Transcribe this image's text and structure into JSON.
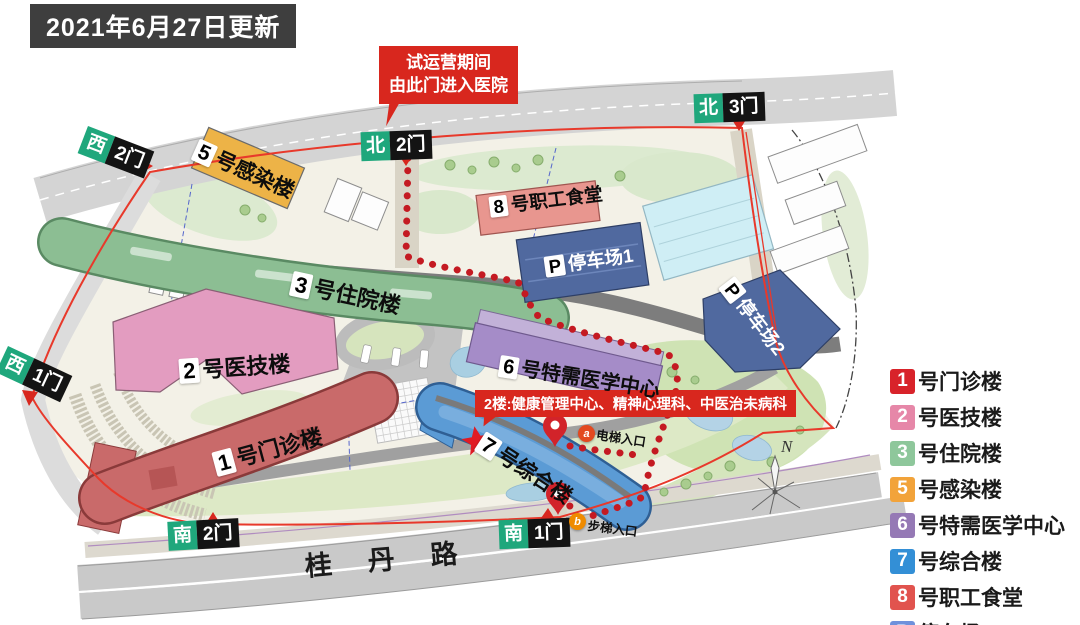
{
  "title_banner": "2021年6月27日更新",
  "callout": {
    "line1": "试运营期间",
    "line2": "由此门进入医院"
  },
  "floor2_note": "2楼:健康管理中心、精神心理科、中医治未病科",
  "road_name": "桂丹路",
  "compass_label": "N",
  "gates": {
    "west2": {
      "direction": "西",
      "gate": "2门"
    },
    "west1": {
      "direction": "西",
      "gate": "1门"
    },
    "north2": {
      "direction": "北",
      "gate": "2门"
    },
    "north3": {
      "direction": "北",
      "gate": "3门"
    },
    "south2": {
      "direction": "南",
      "gate": "2门"
    },
    "south1": {
      "direction": "南",
      "gate": "1门"
    }
  },
  "buildings": {
    "b1": {
      "num": "1",
      "name": "号门诊楼",
      "color": "#c96a6a"
    },
    "b2": {
      "num": "2",
      "name": "号医技楼",
      "color": "#e39cc0"
    },
    "b3": {
      "num": "3",
      "name": "号住院楼",
      "color": "#8cbe93"
    },
    "b5": {
      "num": "5",
      "name": "号感染楼",
      "color": "#edb347"
    },
    "b6": {
      "num": "6",
      "name": "号特需医学中心",
      "color": "#a58cc8"
    },
    "b7": {
      "num": "7",
      "name": "号综合楼",
      "color": "#5b9bd5"
    },
    "b8": {
      "num": "8",
      "name": "号职工食堂",
      "color": "#e8968f"
    },
    "p1": {
      "num": "P",
      "name": "停车场1",
      "color": "#50699f"
    },
    "p2": {
      "num": "P",
      "name": "停车场2",
      "color": "#50699f"
    }
  },
  "markers": {
    "elevator": {
      "letter": "a",
      "label": "电梯入口"
    },
    "stairs": {
      "letter": "b",
      "label": "步梯入口"
    }
  },
  "legend": {
    "items": [
      {
        "num": "1",
        "label": "号门诊楼",
        "color": "#d8232a"
      },
      {
        "num": "2",
        "label": "号医技楼",
        "color": "#e687a8"
      },
      {
        "num": "3",
        "label": "号住院楼",
        "color": "#8ec79b"
      },
      {
        "num": "5",
        "label": "号感染楼",
        "color": "#f2a33a"
      },
      {
        "num": "6",
        "label": "号特需医学中心",
        "color": "#9579b5"
      },
      {
        "num": "7",
        "label": "号综合楼",
        "color": "#338fd6"
      },
      {
        "num": "8",
        "label": "号职工食堂",
        "color": "#e1534e"
      },
      {
        "num": "P",
        "label": "停车场",
        "color": "#6f91dc"
      }
    ]
  }
}
